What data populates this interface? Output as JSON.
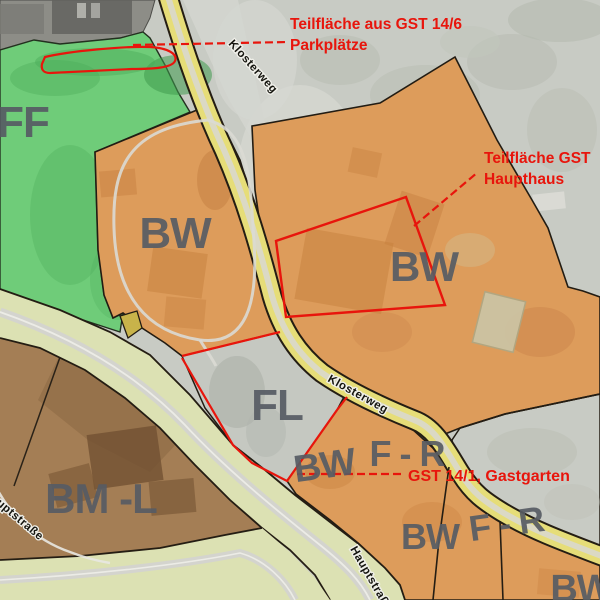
{
  "zones": {
    "ff": "FF",
    "bw": "BW",
    "fl": "FL",
    "bml": "BM -L",
    "fr": "F - R"
  },
  "streets": {
    "klosterweg": "Klosterweg",
    "hauptstrasse": "Hauptstraße"
  },
  "annotations": {
    "parkplaetze": {
      "line1": "Teilfläche aus GST 14/6",
      "line2": "Parkplätze"
    },
    "haupthaus": {
      "line1": "Teilfläche GST",
      "line2": "Haupthaus"
    },
    "gastgarten": {
      "line1": "GST 14/1, Gastgarten"
    }
  },
  "colors": {
    "photo_gray": "#c8cbc4",
    "photo_gray_light": "#d6d8d2",
    "photo_gray_dark": "#b4b9ae",
    "dark_area": "#8d8d87",
    "building_dark": "#63635f",
    "zone_green": "#6fcc79",
    "green_dark": "#53b160",
    "zone_orange": "#dd9c5b",
    "orange_dark": "#c57f3e",
    "zone_brown": "#a47e55",
    "brown_dark": "#6f4f30",
    "road_yellow": "#e6dd78",
    "road_band": "#dce1b3",
    "stripe_gray": "#d4d4ce",
    "fl_gray": "#c5c8c1",
    "parcel_yellow": "#c8b34a",
    "annotation_red": "#e8150c",
    "label_gray": "#575c64"
  }
}
